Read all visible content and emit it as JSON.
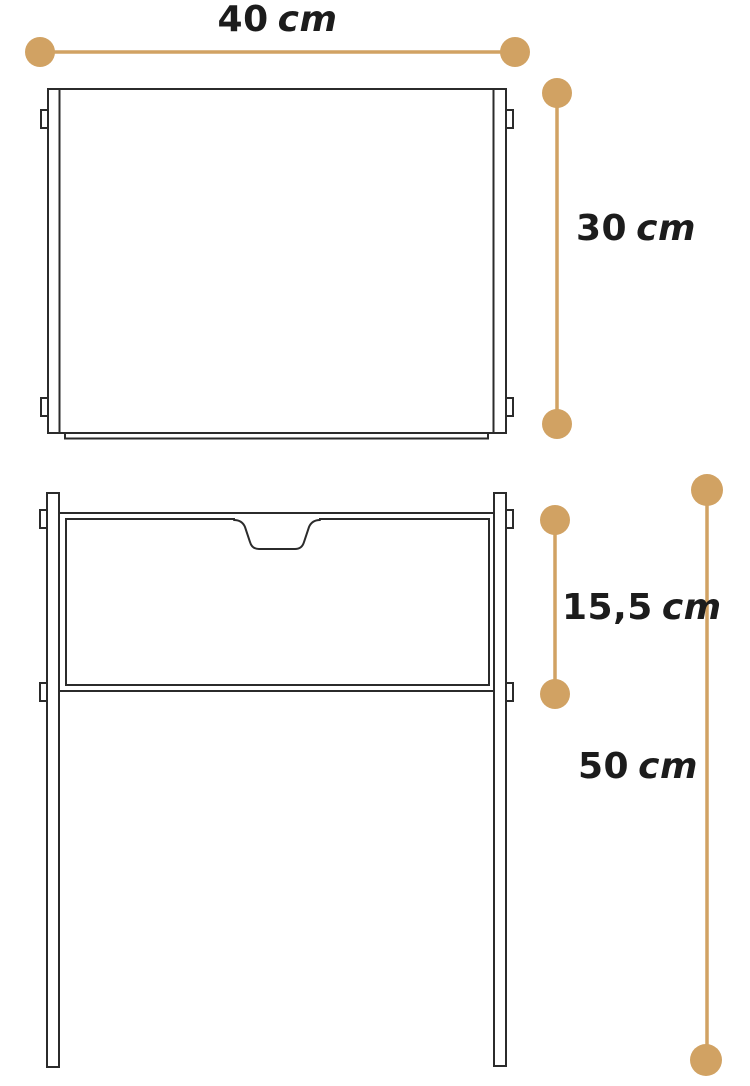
{
  "canvas": {
    "bg": "#ffffff",
    "stroke": "#2b2b2b",
    "accent": "#d1a263"
  },
  "dimensions": {
    "width": {
      "value": "40",
      "unit": "cm"
    },
    "panel_height": {
      "value": "30",
      "unit": "cm"
    },
    "drawer_height": {
      "value": "15,5",
      "unit": "cm"
    },
    "leg_height": {
      "value": "50",
      "unit": "cm"
    }
  }
}
